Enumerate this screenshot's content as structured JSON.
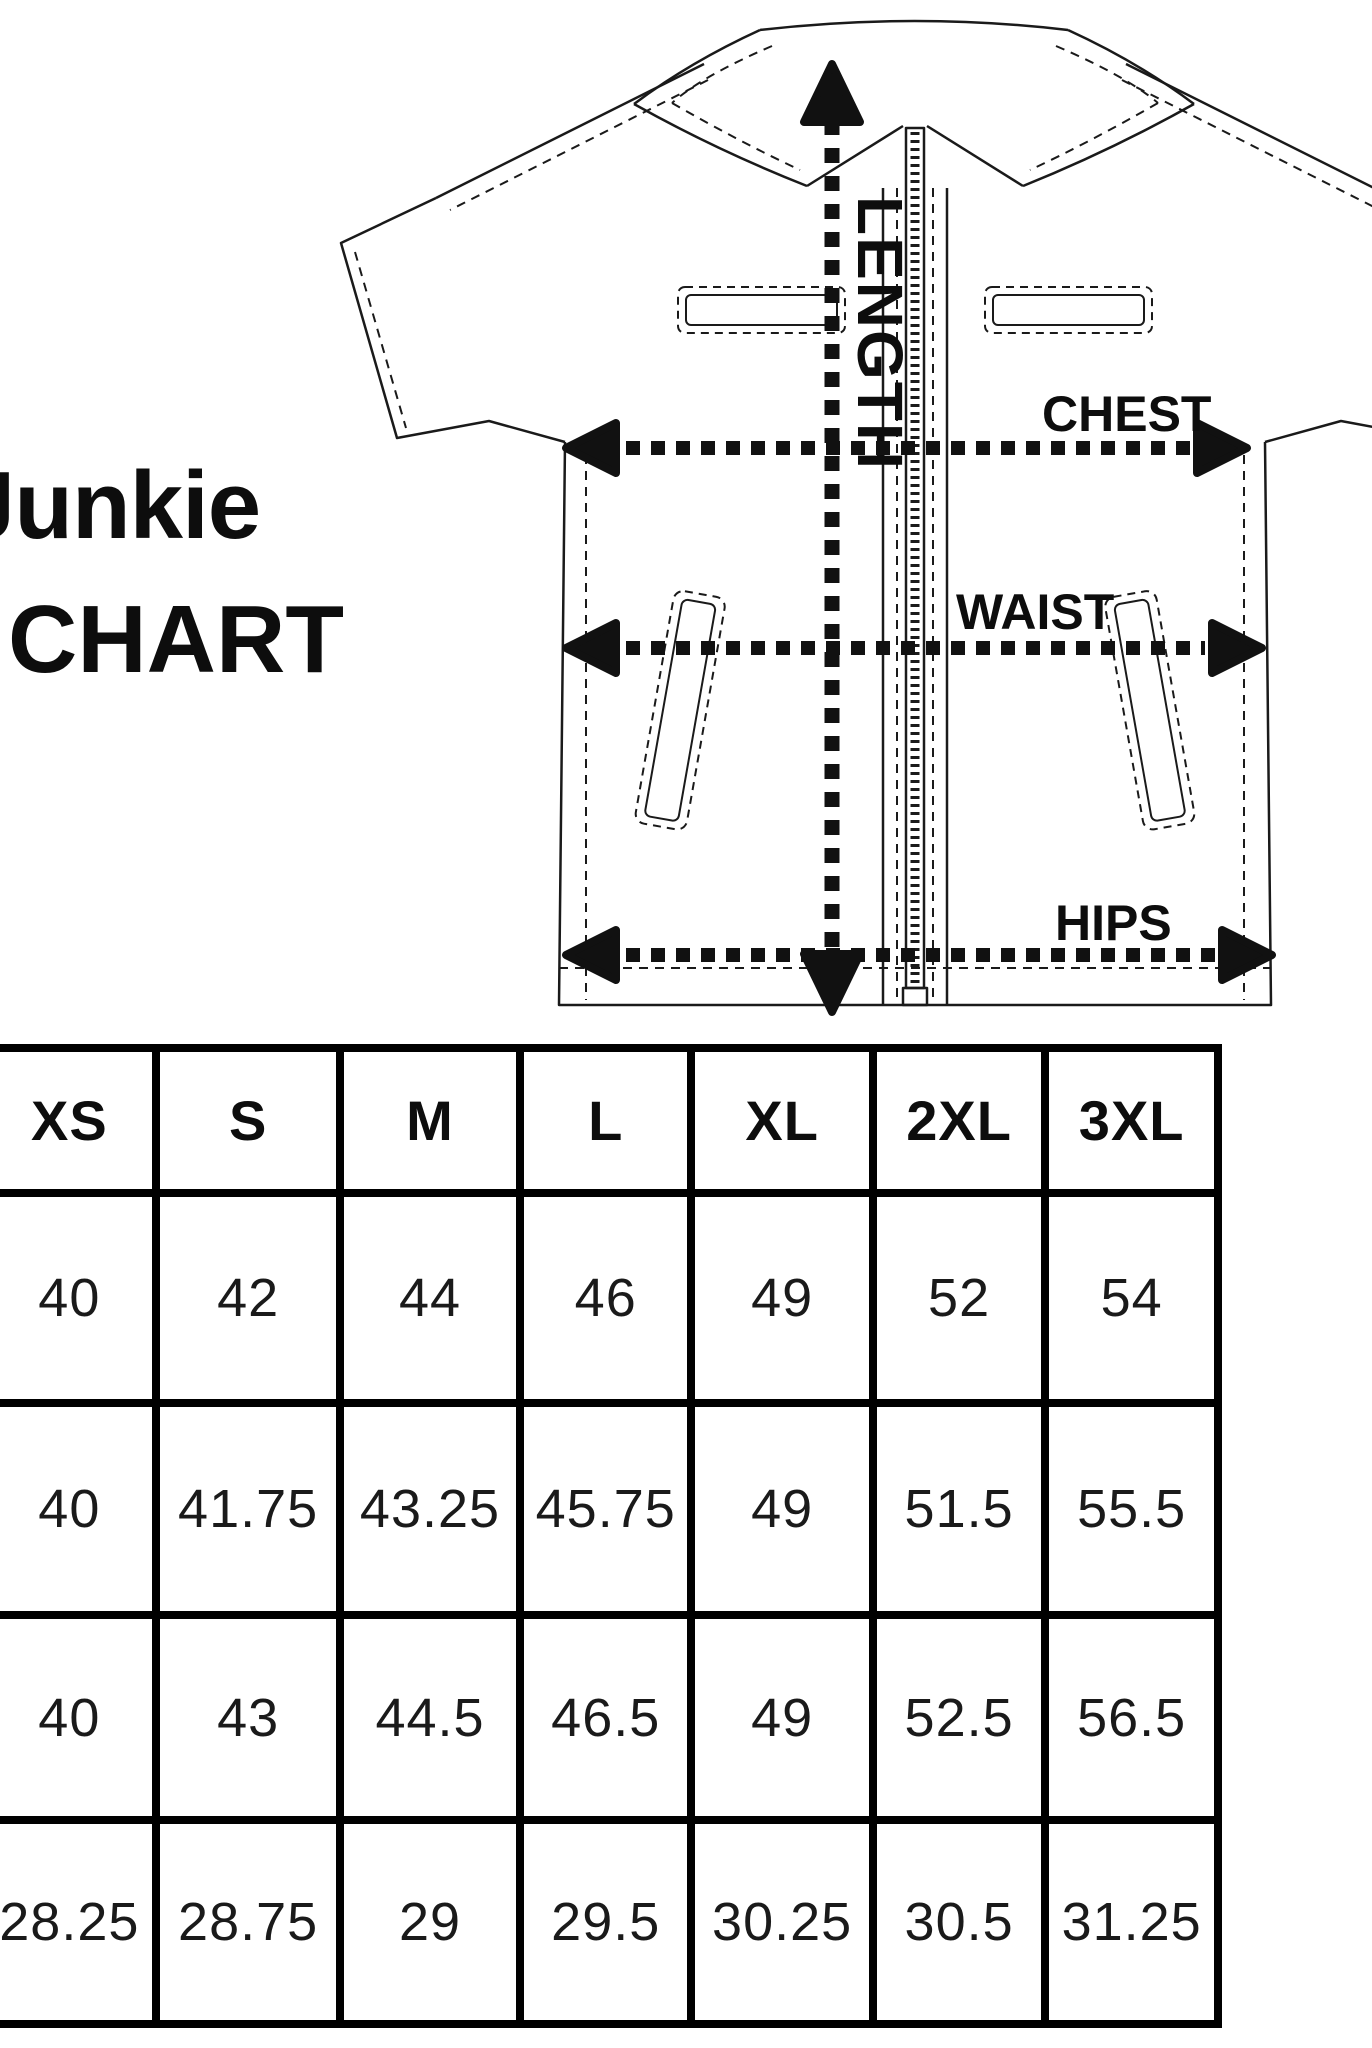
{
  "title": {
    "line1_clipped_letter": "J",
    "line1_visible": "unkie",
    "line2": "CHART"
  },
  "diagram": {
    "labels": {
      "length": "LENGTH",
      "chest": "CHEST",
      "waist": "WAIST",
      "hips": "HIPS"
    }
  },
  "size_table": {
    "columns": [
      "XS",
      "S",
      "M",
      "L",
      "XL",
      "2XL",
      "3XL"
    ],
    "rows": [
      {
        "values": [
          "40",
          "42",
          "44",
          "46",
          "49",
          "52",
          "54"
        ]
      },
      {
        "values": [
          "40",
          "41.75",
          "43.25",
          "45.75",
          "49",
          "51.5",
          "55.5"
        ]
      },
      {
        "values": [
          "40",
          "43",
          "44.5",
          "46.5",
          "49",
          "52.5",
          "56.5"
        ]
      },
      {
        "values": [
          "28.25",
          "28.75",
          "29",
          "29.5",
          "30.25",
          "30.5",
          "31.25"
        ]
      }
    ]
  },
  "colors": {
    "ink": "#111111",
    "background": "#ffffff"
  }
}
